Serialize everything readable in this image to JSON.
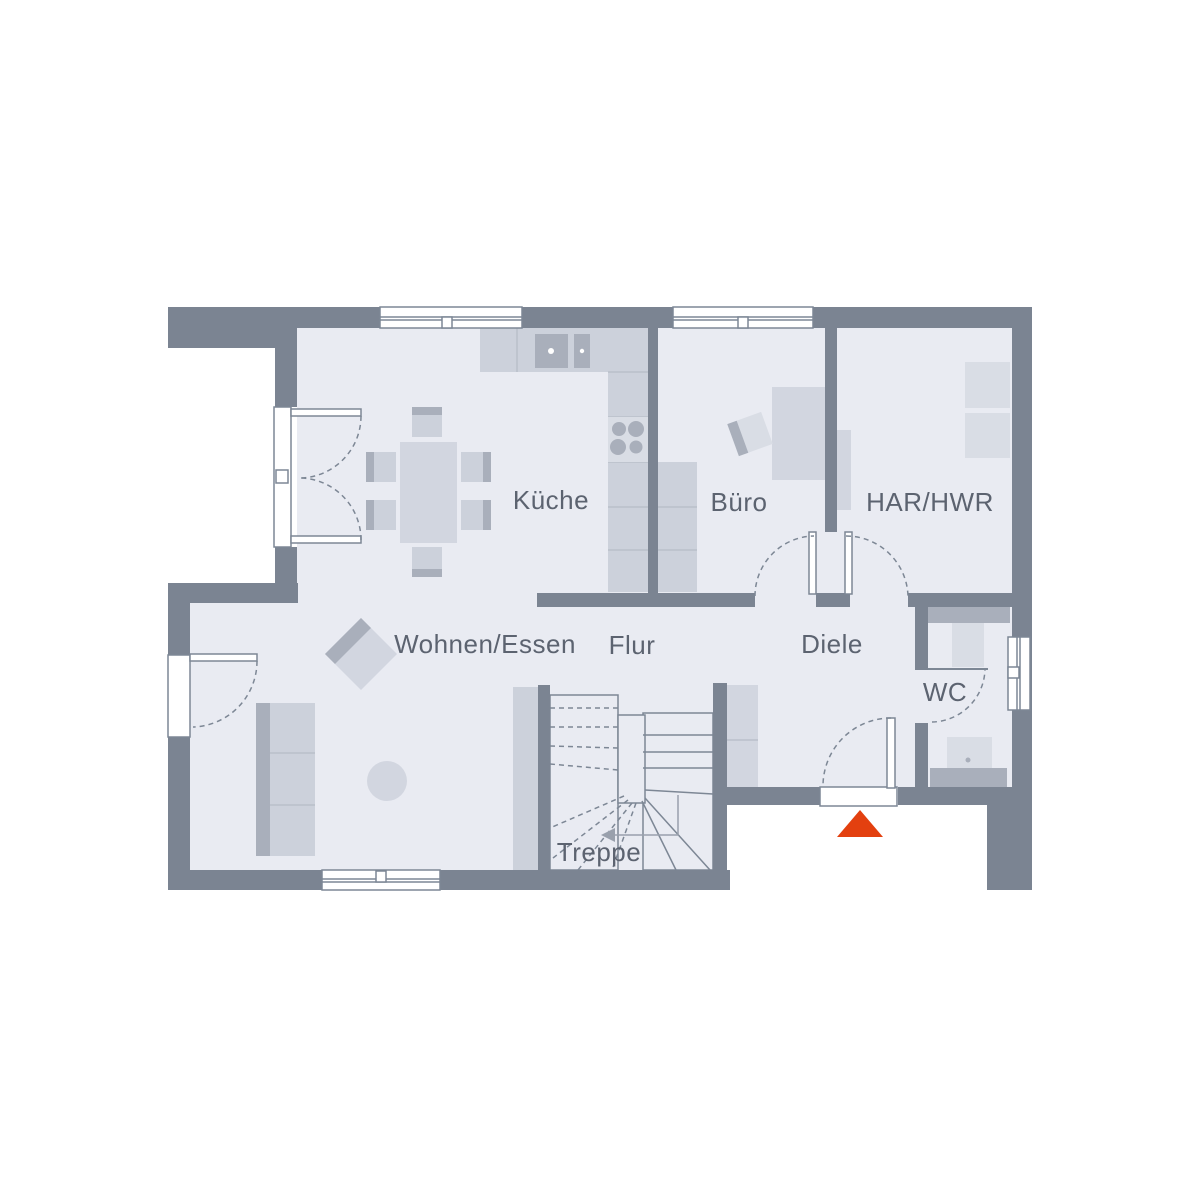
{
  "plan": {
    "type": "floor-plan",
    "floor": "ground-floor"
  },
  "palette": {
    "wall": "#7b8492",
    "floor": "#e9ebf2",
    "line": "#7d8795",
    "divider": "#b9bfca",
    "text": "#5c6370",
    "white": "#ffffff",
    "light": "#ccd1db",
    "mid": "#d2d6e0",
    "dark": "#a9afbb",
    "softer": "#d9dde5",
    "accent": "#e3400f"
  },
  "rooms": [
    {
      "id": "kueche",
      "label": "Küche"
    },
    {
      "id": "buero",
      "label": "Büro"
    },
    {
      "id": "har-hwr",
      "label": "HAR/HWR"
    },
    {
      "id": "wohnen-essen",
      "label": "Wohnen/Essen"
    },
    {
      "id": "flur",
      "label": "Flur"
    },
    {
      "id": "diele",
      "label": "Diele"
    },
    {
      "id": "wc",
      "label": "WC"
    },
    {
      "id": "treppe",
      "label": "Treppe"
    }
  ],
  "icons": {
    "entrance_marker": "triangle-up",
    "stair_direction": "arrow-left"
  },
  "markers": {
    "entrance": {
      "shape": "triangle",
      "color": "#e3400f"
    }
  }
}
